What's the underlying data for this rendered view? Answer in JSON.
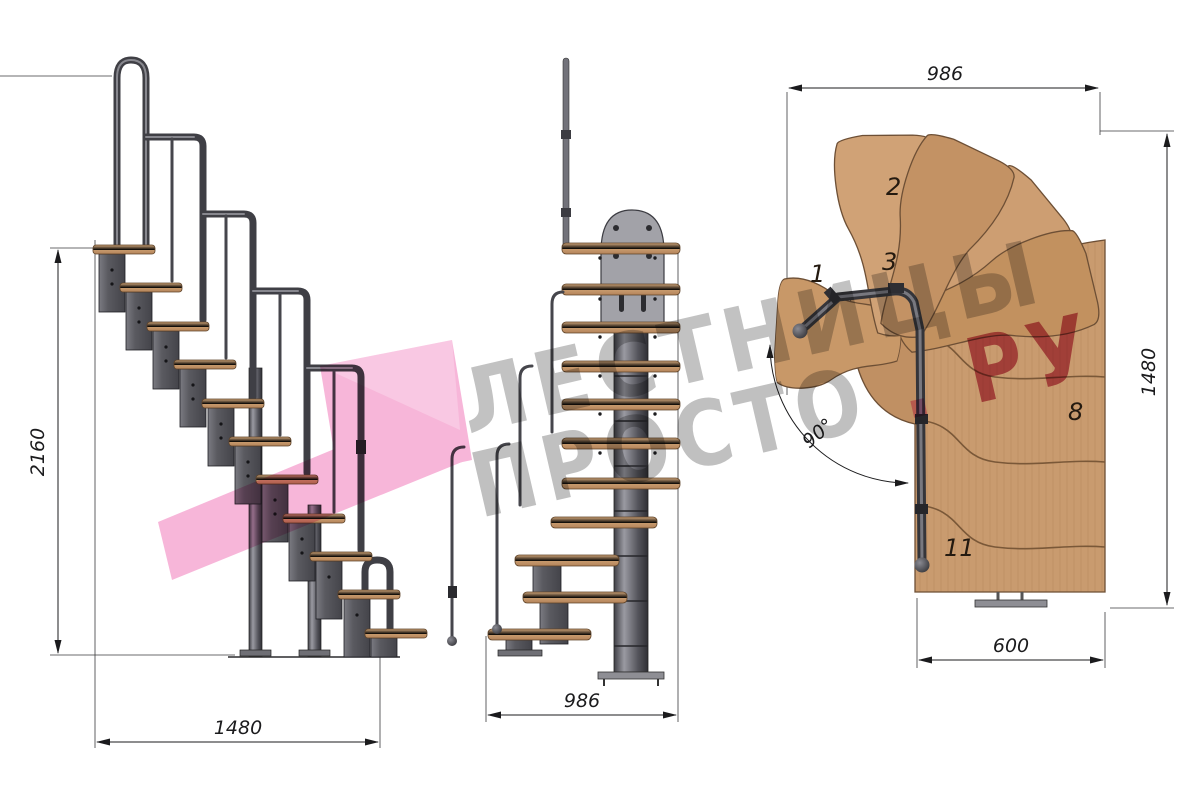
{
  "side_view": {
    "height_dim": "2160",
    "length_dim": "1480"
  },
  "front_view": {
    "width_dim": "986"
  },
  "plan_view": {
    "width_dim": "986",
    "depth_dim": "1480",
    "exit_dim": "600",
    "turn_angle": "90°",
    "step_labels": [
      "1",
      "2",
      "3",
      "8",
      "11"
    ]
  },
  "watermark": {
    "line1": "ЛЕСТНИЦЫ",
    "line2_main": "ПРОСТО",
    "line2_dot": ".",
    "line2_suffix": "РУ",
    "gray": "#8f8f8f",
    "red": "#c0425f",
    "dot_pink": "#ef86b9",
    "logo_pink": "#f06eb4"
  },
  "colors": {
    "wood": "#c89a6e",
    "wood_dark": "#b8885c",
    "outline": "#6d4f35",
    "metal": "#55555a",
    "metal_light": "#9a9aa2",
    "dim_line": "#1b1b1d"
  }
}
